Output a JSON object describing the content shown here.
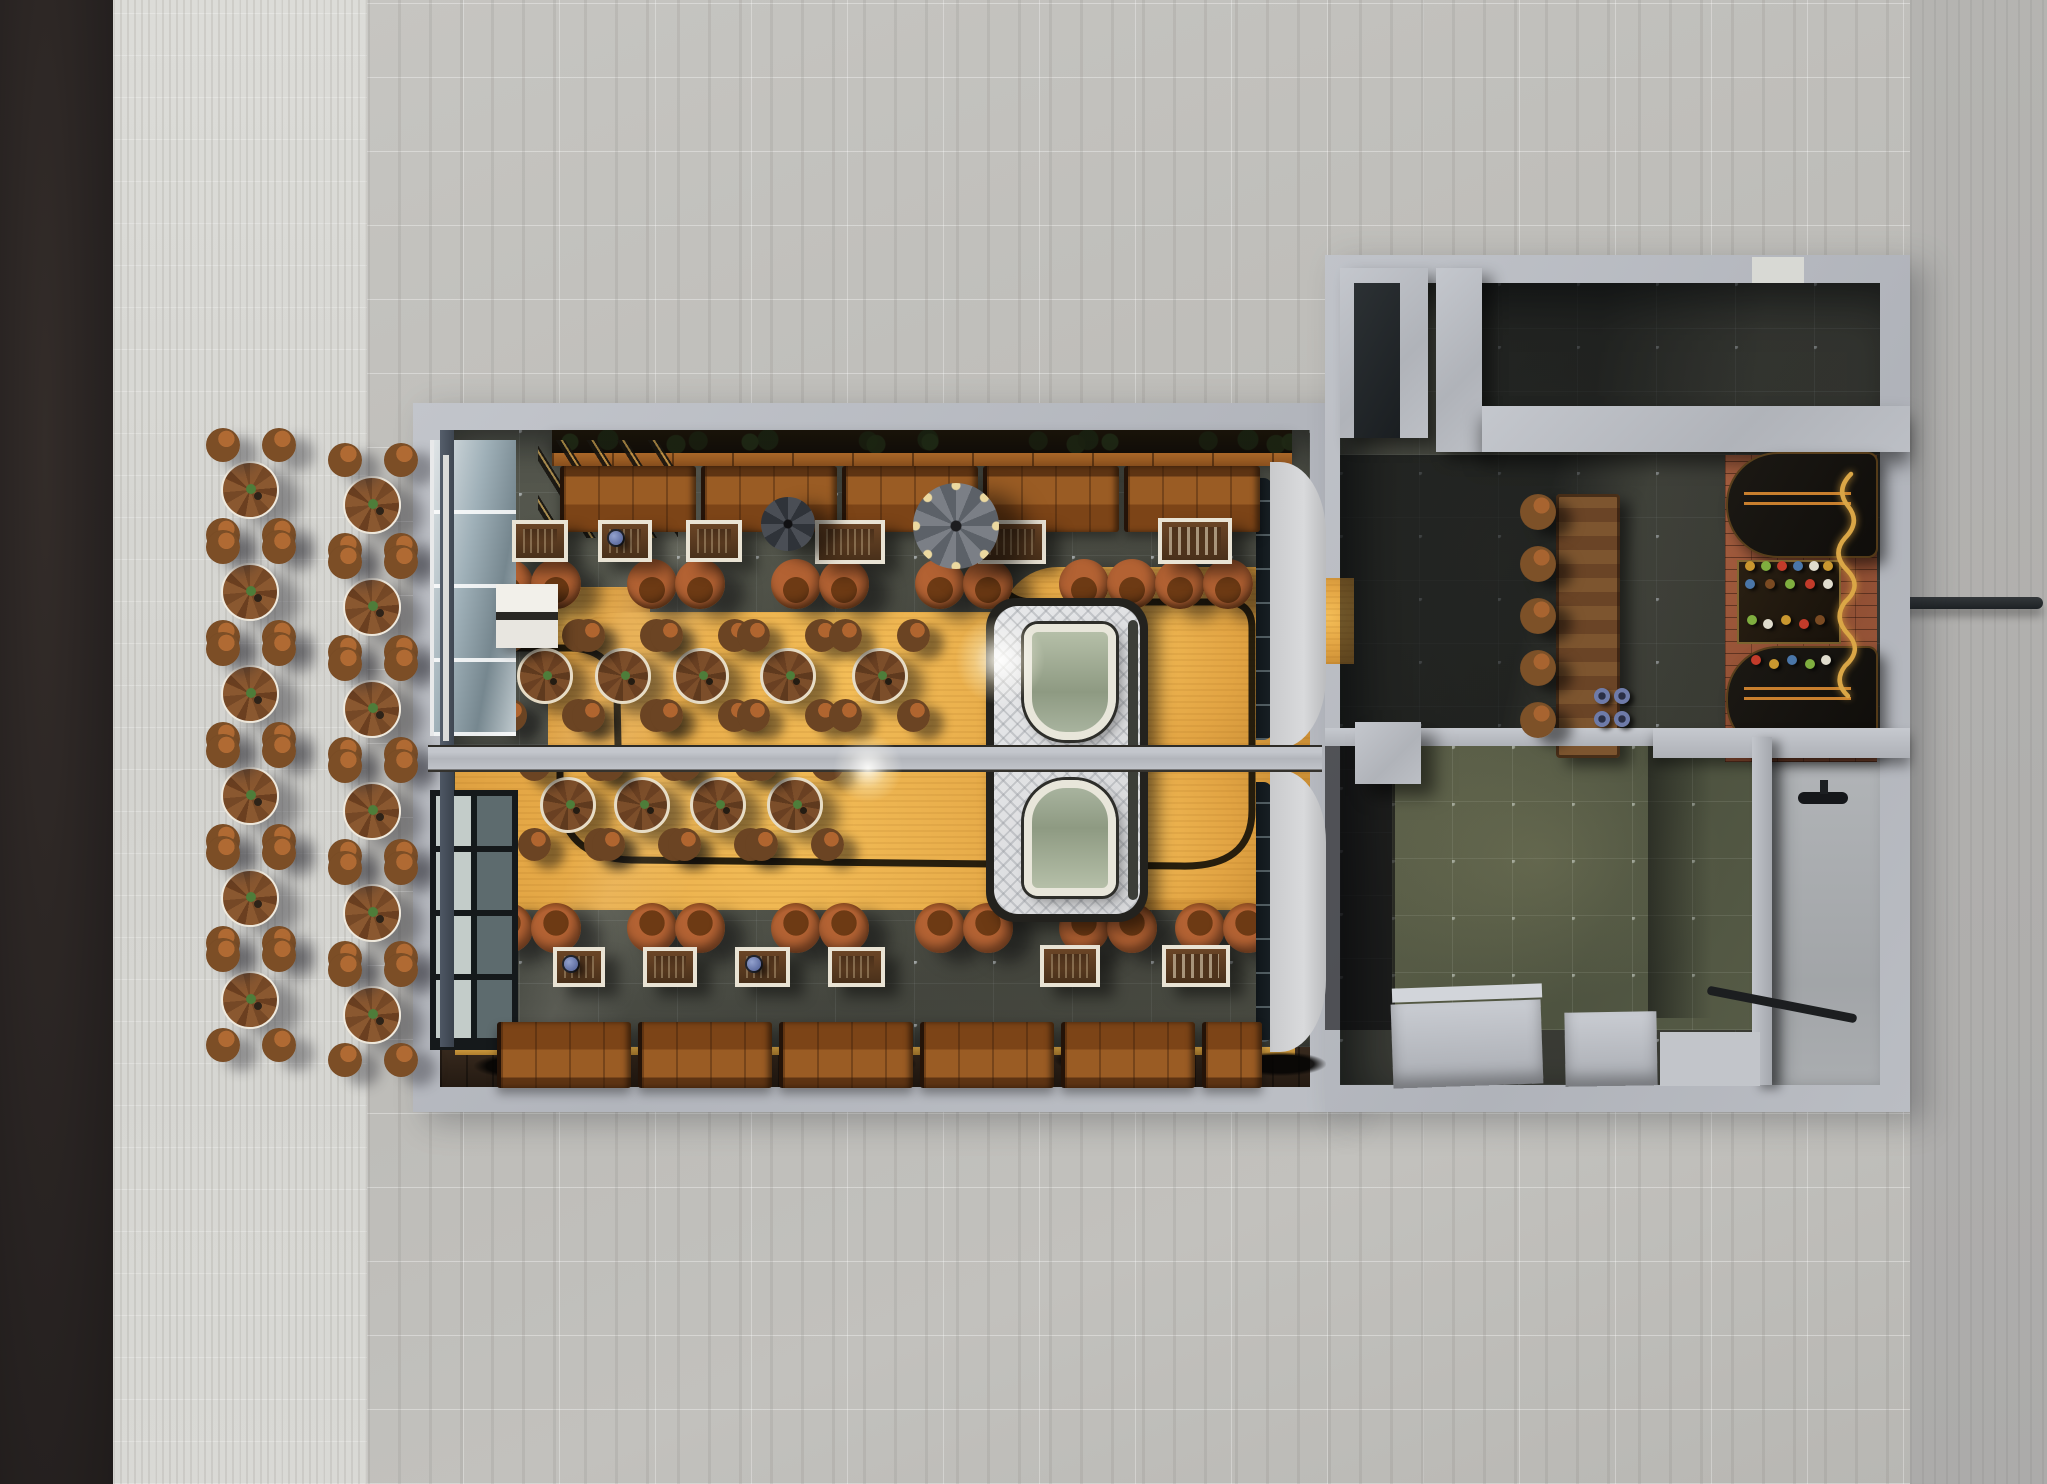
{
  "palette": {
    "asphalt": "#272221",
    "pavement": "#d8d8d4",
    "marble": "#c0bfbb",
    "concrete_wall": "#b6b9bf",
    "slate_floor": "#4a4c41",
    "gold_path": "#e2a443",
    "booth_leather": "#9a5c24",
    "chair_rust": "#a85a28",
    "wood_table": "#7c4e2a",
    "brick_floor": "#a05a3d",
    "trailer_body": "#dfe0e2",
    "script_sign": "#daa646"
  },
  "scene": {
    "outdoor": {
      "tables": [
        {
          "x": 250,
          "y": 490
        },
        {
          "x": 250,
          "y": 592
        },
        {
          "x": 250,
          "y": 694
        },
        {
          "x": 250,
          "y": 796
        },
        {
          "x": 250,
          "y": 898
        },
        {
          "x": 250,
          "y": 1000
        },
        {
          "x": 372,
          "y": 505
        },
        {
          "x": 372,
          "y": 607
        },
        {
          "x": 372,
          "y": 709
        },
        {
          "x": 372,
          "y": 811
        },
        {
          "x": 372,
          "y": 913
        },
        {
          "x": 372,
          "y": 1015
        }
      ],
      "stools": [
        {
          "x": 223,
          "y": 445
        },
        {
          "x": 279,
          "y": 445
        },
        {
          "x": 223,
          "y": 535
        },
        {
          "x": 279,
          "y": 535
        },
        {
          "x": 223,
          "y": 547
        },
        {
          "x": 279,
          "y": 547
        },
        {
          "x": 223,
          "y": 637
        },
        {
          "x": 279,
          "y": 637
        },
        {
          "x": 223,
          "y": 649
        },
        {
          "x": 279,
          "y": 649
        },
        {
          "x": 223,
          "y": 739
        },
        {
          "x": 279,
          "y": 739
        },
        {
          "x": 223,
          "y": 751
        },
        {
          "x": 279,
          "y": 751
        },
        {
          "x": 223,
          "y": 841
        },
        {
          "x": 279,
          "y": 841
        },
        {
          "x": 223,
          "y": 853
        },
        {
          "x": 279,
          "y": 853
        },
        {
          "x": 223,
          "y": 943
        },
        {
          "x": 279,
          "y": 943
        },
        {
          "x": 223,
          "y": 955
        },
        {
          "x": 279,
          "y": 955
        },
        {
          "x": 223,
          "y": 1045
        },
        {
          "x": 279,
          "y": 1045
        },
        {
          "x": 345,
          "y": 460
        },
        {
          "x": 401,
          "y": 460
        },
        {
          "x": 345,
          "y": 550
        },
        {
          "x": 401,
          "y": 550
        },
        {
          "x": 345,
          "y": 562
        },
        {
          "x": 401,
          "y": 562
        },
        {
          "x": 345,
          "y": 652
        },
        {
          "x": 401,
          "y": 652
        },
        {
          "x": 345,
          "y": 664
        },
        {
          "x": 401,
          "y": 664
        },
        {
          "x": 345,
          "y": 754
        },
        {
          "x": 401,
          "y": 754
        },
        {
          "x": 345,
          "y": 766
        },
        {
          "x": 401,
          "y": 766
        },
        {
          "x": 345,
          "y": 856
        },
        {
          "x": 401,
          "y": 856
        },
        {
          "x": 345,
          "y": 868
        },
        {
          "x": 401,
          "y": 868
        },
        {
          "x": 345,
          "y": 958
        },
        {
          "x": 401,
          "y": 958
        },
        {
          "x": 345,
          "y": 970
        },
        {
          "x": 401,
          "y": 970
        },
        {
          "x": 345,
          "y": 1060
        },
        {
          "x": 401,
          "y": 1060
        }
      ]
    },
    "dining_top": {
      "booths": [
        {
          "x": 560,
          "y": 466,
          "w": 136
        },
        {
          "x": 701,
          "y": 466,
          "w": 136
        },
        {
          "x": 842,
          "y": 466,
          "w": 136
        },
        {
          "x": 983,
          "y": 466,
          "w": 136
        },
        {
          "x": 1124,
          "y": 466,
          "w": 136
        }
      ],
      "frames": [
        {
          "x": 512,
          "y": 520,
          "w": 56,
          "h": 42
        },
        {
          "x": 598,
          "y": 520,
          "w": 54,
          "h": 42,
          "cls": "jukebox"
        },
        {
          "x": 686,
          "y": 520,
          "w": 56,
          "h": 42
        },
        {
          "x": 815,
          "y": 520,
          "w": 70,
          "h": 44
        },
        {
          "x": 978,
          "y": 520,
          "w": 68,
          "h": 44
        },
        {
          "x": 1158,
          "y": 518,
          "w": 74,
          "h": 46,
          "cls": "sign"
        }
      ],
      "chairs": [
        {
          "x": 508,
          "y": 584
        },
        {
          "x": 556,
          "y": 584
        },
        {
          "x": 652,
          "y": 584
        },
        {
          "x": 700,
          "y": 584
        },
        {
          "x": 796,
          "y": 584
        },
        {
          "x": 844,
          "y": 584
        },
        {
          "x": 940,
          "y": 584
        },
        {
          "x": 988,
          "y": 584
        },
        {
          "x": 1084,
          "y": 584
        },
        {
          "x": 1132,
          "y": 584
        },
        {
          "x": 1180,
          "y": 584
        },
        {
          "x": 1228,
          "y": 584
        }
      ],
      "round_tables": [
        {
          "x": 545,
          "y": 676
        },
        {
          "x": 623,
          "y": 676
        },
        {
          "x": 701,
          "y": 676
        },
        {
          "x": 788,
          "y": 676
        },
        {
          "x": 880,
          "y": 676
        }
      ],
      "table_stools": [
        {
          "x": 511,
          "y": 636
        },
        {
          "x": 579,
          "y": 636
        },
        {
          "x": 511,
          "y": 716
        },
        {
          "x": 579,
          "y": 716
        },
        {
          "x": 589,
          "y": 636
        },
        {
          "x": 657,
          "y": 636
        },
        {
          "x": 589,
          "y": 716
        },
        {
          "x": 657,
          "y": 716
        },
        {
          "x": 667,
          "y": 636
        },
        {
          "x": 735,
          "y": 636
        },
        {
          "x": 667,
          "y": 716
        },
        {
          "x": 735,
          "y": 716
        },
        {
          "x": 754,
          "y": 636
        },
        {
          "x": 822,
          "y": 636
        },
        {
          "x": 754,
          "y": 716
        },
        {
          "x": 822,
          "y": 716
        },
        {
          "x": 846,
          "y": 636
        },
        {
          "x": 914,
          "y": 636
        },
        {
          "x": 846,
          "y": 716
        },
        {
          "x": 914,
          "y": 716
        }
      ],
      "fans": [
        {
          "x": 788,
          "y": 524,
          "cls": "small"
        },
        {
          "x": 956,
          "y": 526,
          "cls": "large"
        }
      ]
    },
    "dining_bottom": {
      "booths": [
        {
          "x": 497,
          "y": 1022,
          "w": 134,
          "cls": "flip"
        },
        {
          "x": 638,
          "y": 1022,
          "w": 134,
          "cls": "flip"
        },
        {
          "x": 779,
          "y": 1022,
          "w": 134,
          "cls": "flip"
        },
        {
          "x": 920,
          "y": 1022,
          "w": 134,
          "cls": "flip"
        },
        {
          "x": 1061,
          "y": 1022,
          "w": 134,
          "cls": "flip"
        },
        {
          "x": 1202,
          "y": 1022,
          "w": 60,
          "cls": "flip"
        }
      ],
      "frames": [
        {
          "x": 553,
          "y": 947,
          "w": 52,
          "h": 40,
          "cls": "jukebox"
        },
        {
          "x": 643,
          "y": 947,
          "w": 54,
          "h": 40
        },
        {
          "x": 735,
          "y": 947,
          "w": 55,
          "h": 40,
          "cls": "jukebox"
        },
        {
          "x": 828,
          "y": 947,
          "w": 57,
          "h": 40
        },
        {
          "x": 1040,
          "y": 945,
          "w": 60,
          "h": 42
        },
        {
          "x": 1162,
          "y": 945,
          "w": 68,
          "h": 42,
          "cls": "sign"
        }
      ],
      "chairs": [
        {
          "x": 508,
          "y": 928,
          "cls": "flip"
        },
        {
          "x": 556,
          "y": 928,
          "cls": "flip"
        },
        {
          "x": 652,
          "y": 928,
          "cls": "flip"
        },
        {
          "x": 700,
          "y": 928,
          "cls": "flip"
        },
        {
          "x": 796,
          "y": 928,
          "cls": "flip"
        },
        {
          "x": 844,
          "y": 928,
          "cls": "flip"
        },
        {
          "x": 940,
          "y": 928,
          "cls": "flip"
        },
        {
          "x": 988,
          "y": 928,
          "cls": "flip"
        },
        {
          "x": 1084,
          "y": 928,
          "cls": "flip"
        },
        {
          "x": 1132,
          "y": 928,
          "cls": "flip"
        },
        {
          "x": 1200,
          "y": 928,
          "cls": "flip"
        },
        {
          "x": 1248,
          "y": 928,
          "cls": "flip"
        }
      ],
      "round_tables": [
        {
          "x": 568,
          "y": 805
        },
        {
          "x": 642,
          "y": 805
        },
        {
          "x": 718,
          "y": 805
        },
        {
          "x": 795,
          "y": 805
        }
      ],
      "table_stools": [
        {
          "x": 535,
          "y": 765
        },
        {
          "x": 601,
          "y": 765
        },
        {
          "x": 535,
          "y": 845
        },
        {
          "x": 601,
          "y": 845
        },
        {
          "x": 609,
          "y": 765
        },
        {
          "x": 675,
          "y": 765
        },
        {
          "x": 609,
          "y": 845
        },
        {
          "x": 675,
          "y": 845
        },
        {
          "x": 685,
          "y": 765
        },
        {
          "x": 751,
          "y": 765
        },
        {
          "x": 685,
          "y": 845
        },
        {
          "x": 751,
          "y": 845
        },
        {
          "x": 762,
          "y": 765
        },
        {
          "x": 828,
          "y": 765
        },
        {
          "x": 762,
          "y": 845
        },
        {
          "x": 828,
          "y": 845
        }
      ],
      "decals": [
        {
          "x": 520,
          "y": 1066
        },
        {
          "x": 700,
          "y": 1066,
          "cls": "tilt"
        },
        {
          "x": 870,
          "y": 1064
        },
        {
          "x": 1100,
          "y": 1066,
          "cls": "tilt"
        },
        {
          "x": 1280,
          "y": 1064
        }
      ]
    },
    "right_wing": {
      "bar_stools": [
        {
          "x": 1538,
          "y": 512
        },
        {
          "x": 1538,
          "y": 564
        },
        {
          "x": 1538,
          "y": 616
        },
        {
          "x": 1538,
          "y": 668
        },
        {
          "x": 1538,
          "y": 720
        }
      ],
      "cups": [
        {
          "x": 1602,
          "y": 696
        },
        {
          "x": 1622,
          "y": 696
        },
        {
          "x": 1602,
          "y": 719
        },
        {
          "x": 1622,
          "y": 719
        }
      ],
      "bottles": [
        {
          "x": 1750,
          "y": 566,
          "cls": "bt1"
        },
        {
          "x": 1766,
          "y": 566,
          "cls": "bt2"
        },
        {
          "x": 1782,
          "y": 566,
          "cls": "bt3"
        },
        {
          "x": 1798,
          "y": 566,
          "cls": "bt4"
        },
        {
          "x": 1814,
          "y": 566,
          "cls": "bt5"
        },
        {
          "x": 1828,
          "y": 566,
          "cls": "bt1"
        },
        {
          "x": 1750,
          "y": 584,
          "cls": "bt4"
        },
        {
          "x": 1770,
          "y": 584,
          "cls": "bt6"
        },
        {
          "x": 1790,
          "y": 584,
          "cls": "bt2"
        },
        {
          "x": 1810,
          "y": 584,
          "cls": "bt3"
        },
        {
          "x": 1828,
          "y": 584,
          "cls": "bt5"
        },
        {
          "x": 1752,
          "y": 620,
          "cls": "bt2"
        },
        {
          "x": 1768,
          "y": 624,
          "cls": "bt5"
        },
        {
          "x": 1786,
          "y": 620,
          "cls": "bt1"
        },
        {
          "x": 1804,
          "y": 624,
          "cls": "bt3"
        },
        {
          "x": 1820,
          "y": 620,
          "cls": "bt6"
        },
        {
          "x": 1756,
          "y": 660,
          "cls": "bt3"
        },
        {
          "x": 1774,
          "y": 664,
          "cls": "bt1"
        },
        {
          "x": 1792,
          "y": 660,
          "cls": "bt4"
        },
        {
          "x": 1810,
          "y": 664,
          "cls": "bt2"
        },
        {
          "x": 1826,
          "y": 660,
          "cls": "bt5"
        }
      ]
    },
    "paths": {
      "top_line": "M500 648 L572 648 Q616 650 617 696 L618 745 M1000 575 Q1003 602 1034 602 L1226 602 Q1252 602 1252 628 L1252 745",
      "bottom_line": "M560 772 L560 792 Q560 858 632 860 L1180 866 Q1252 868 1252 810 L1252 772",
      "script_sign": "M1851 474 q-16 16 -3 32 q13 16 -3 32 q-14 16 2 32 q16 16 -2 32 q-12 16 3 32 q15 16 -3 32 q-12 16 3 30"
    }
  }
}
